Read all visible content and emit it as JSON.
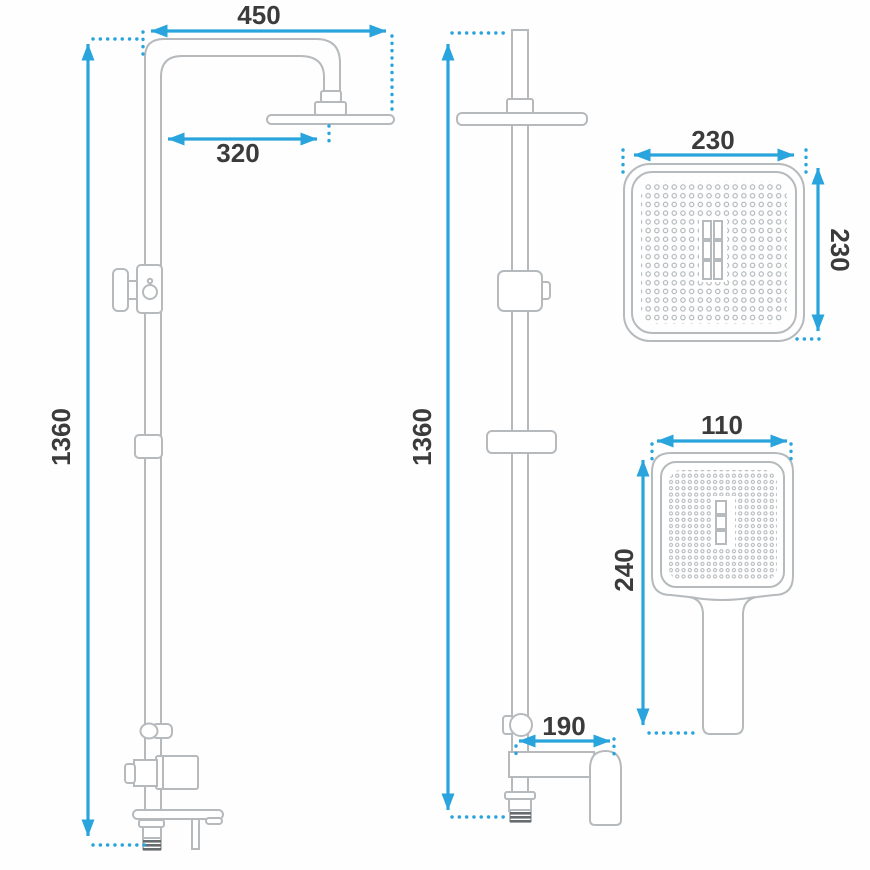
{
  "title": "shower-set-technical-drawing",
  "colors": {
    "dimension_blue": "#2aa4dc",
    "line_gray": "#b6babd",
    "label_dark": "#3b3b3b",
    "thread_dark": "#666b6e",
    "background": "#fefefe"
  },
  "views": {
    "side": {
      "dims": {
        "arm_width": "450",
        "head_offset": "320",
        "column_height": "1360"
      }
    },
    "front": {
      "dims": {
        "column_height": "1360",
        "spout_length": "190"
      }
    },
    "head": {
      "dims": {
        "width": "230",
        "depth": "230"
      }
    },
    "hand": {
      "dims": {
        "width": "110",
        "length": "240"
      }
    }
  }
}
